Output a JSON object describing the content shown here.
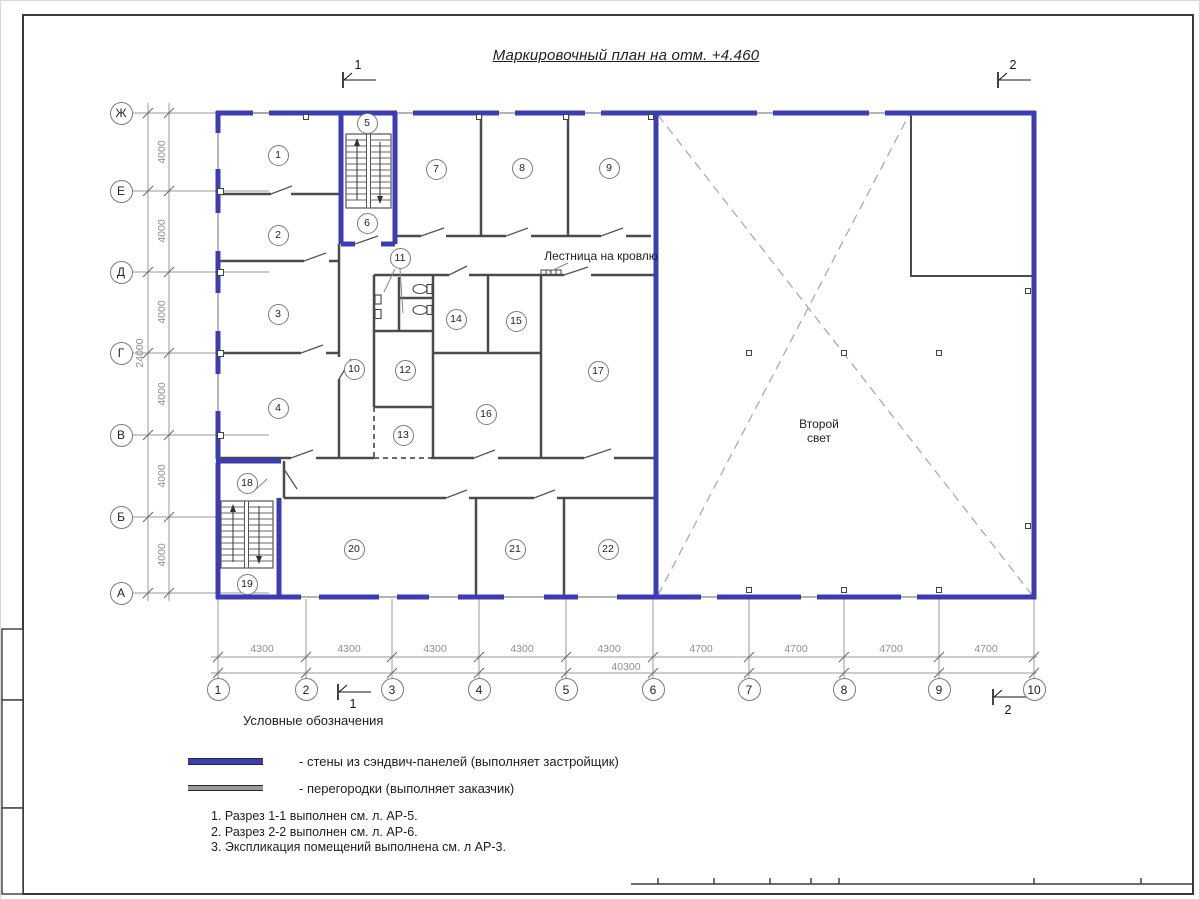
{
  "sheet": {
    "title": "Маркировочный план на отм. +4.460"
  },
  "colors": {
    "wall_blue": "#3c3cb4",
    "partition": "#4b4b4b",
    "dim_gray": "#9a9a9a"
  },
  "plan": {
    "labels": {
      "stair_roof": "Лестница на кровлю",
      "second_light_1": "Второй",
      "second_light_2": "свет"
    },
    "rooms": [
      {
        "n": "1",
        "x": 277,
        "y": 154
      },
      {
        "n": "2",
        "x": 277,
        "y": 234
      },
      {
        "n": "3",
        "x": 277,
        "y": 313
      },
      {
        "n": "4",
        "x": 277,
        "y": 407
      },
      {
        "n": "5",
        "x": 366,
        "y": 122
      },
      {
        "n": "6",
        "x": 366,
        "y": 222
      },
      {
        "n": "7",
        "x": 435,
        "y": 168
      },
      {
        "n": "8",
        "x": 521,
        "y": 167
      },
      {
        "n": "9",
        "x": 608,
        "y": 167
      },
      {
        "n": "10",
        "x": 353,
        "y": 368
      },
      {
        "n": "11",
        "x": 399,
        "y": 257
      },
      {
        "n": "12",
        "x": 404,
        "y": 369
      },
      {
        "n": "13",
        "x": 402,
        "y": 434
      },
      {
        "n": "14",
        "x": 455,
        "y": 318
      },
      {
        "n": "15",
        "x": 515,
        "y": 320
      },
      {
        "n": "16",
        "x": 485,
        "y": 413
      },
      {
        "n": "17",
        "x": 597,
        "y": 370
      },
      {
        "n": "18",
        "x": 246,
        "y": 482
      },
      {
        "n": "19",
        "x": 246,
        "y": 583
      },
      {
        "n": "20",
        "x": 353,
        "y": 548
      },
      {
        "n": "21",
        "x": 514,
        "y": 548
      },
      {
        "n": "22",
        "x": 607,
        "y": 548
      }
    ],
    "axes_rows": [
      {
        "label": "Ж",
        "y": 112
      },
      {
        "label": "Е",
        "y": 190
      },
      {
        "label": "Д",
        "y": 271
      },
      {
        "label": "Г",
        "y": 352
      },
      {
        "label": "В",
        "y": 434
      },
      {
        "label": "Б",
        "y": 516
      },
      {
        "label": "А",
        "y": 592
      }
    ],
    "axes_cols": [
      {
        "label": "1",
        "x": 217
      },
      {
        "label": "2",
        "x": 305
      },
      {
        "label": "3",
        "x": 391
      },
      {
        "label": "4",
        "x": 478
      },
      {
        "label": "5",
        "x": 565
      },
      {
        "label": "6",
        "x": 652
      },
      {
        "label": "7",
        "x": 748
      },
      {
        "label": "8",
        "x": 843
      },
      {
        "label": "9",
        "x": 938
      },
      {
        "label": "10",
        "x": 1033
      }
    ],
    "dims_left": [
      {
        "value": "4000",
        "y": 151
      },
      {
        "value": "4000",
        "y": 230
      },
      {
        "value": "4000",
        "y": 311
      },
      {
        "value": "4000",
        "y": 393
      },
      {
        "value": "4000",
        "y": 475
      },
      {
        "value": "4000",
        "y": 554
      }
    ],
    "dims_left_total": {
      "value": "24000",
      "x": 139,
      "y": 352
    },
    "dims_bottom": [
      {
        "value": "4300",
        "x": 261
      },
      {
        "value": "4300",
        "x": 348
      },
      {
        "value": "4300",
        "x": 434
      },
      {
        "value": "4300",
        "x": 521
      },
      {
        "value": "4300",
        "x": 608
      },
      {
        "value": "4700",
        "x": 700
      },
      {
        "value": "4700",
        "x": 795
      },
      {
        "value": "4700",
        "x": 890
      },
      {
        "value": "4700",
        "x": 985
      }
    ],
    "dims_bottom_total": {
      "value": "40300",
      "x": 625,
      "y": 666
    },
    "section_marks": [
      {
        "label": "1",
        "x": 342,
        "y": 79,
        "nx": 357,
        "ny": 64
      },
      {
        "label": "2",
        "x": 997,
        "y": 79,
        "nx": 1012,
        "ny": 64
      },
      {
        "label": "1",
        "x": 337,
        "y": 691,
        "nx": 352,
        "ny": 703
      },
      {
        "label": "2",
        "x": 992,
        "y": 696,
        "nx": 1007,
        "ny": 709
      }
    ]
  },
  "legend": {
    "heading": "Условные обозначения",
    "items": [
      {
        "swatch": "#3c3cb4",
        "height": 5,
        "label": "- стены из сэндвич-панелей (выполняет застройщик)"
      },
      {
        "swatch": "#9a9a9a",
        "height": 4,
        "label": "- перегородки (выполняет заказчик)"
      }
    ]
  },
  "notes": [
    "1. Разрез 1-1 выполнен см. л. АР-5.",
    "2. Разрез 2-2 выполнен см. л. АР-6.",
    "3. Экспликация помещений выполнена см. л АР-3."
  ]
}
